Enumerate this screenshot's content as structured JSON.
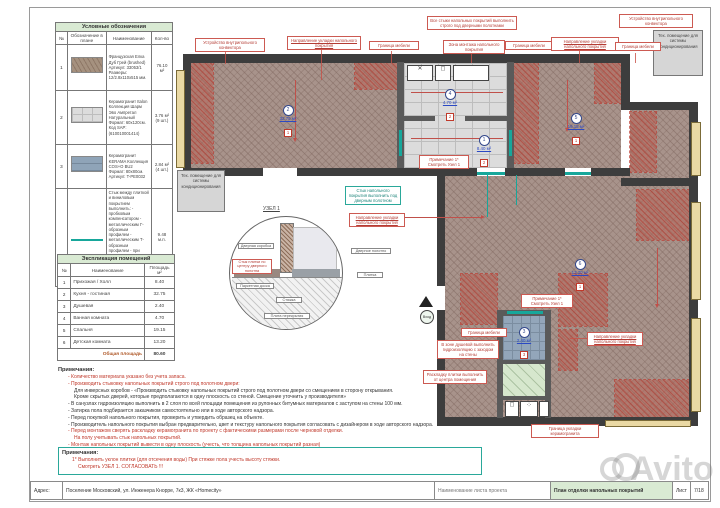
{
  "legend": {
    "title": "Условные обозначения",
    "col_no": "№",
    "col_symbol": "Обозначение в плане",
    "col_name": "Наименование",
    "col_qty": "Кол-во",
    "rows": [
      {
        "no": "1",
        "name": "Французская Елка Дуб Грей (brushed) Артикул: 33053/1 Размеры: 12/2.8х110х515 мм.",
        "qty": "76.10 м²"
      },
      {
        "no": "2",
        "name": "Керамогранит Italon Коллекция Шарм Эво Ампретал Натуральный Формат: 60х120см. Код SAP: (610010001414)",
        "qty": "3.76 м² (9 шт.)"
      },
      {
        "no": "3",
        "name": "Керамогранит KERAMA Коллекция COS+O BU2 Формат: 80х80см. Артикул: T-PE0032",
        "qty": "2.84 м² (4 шт.)"
      },
      {
        "no": "",
        "name": "Стык между плиткой и виниловым покрытием выполнить: - пробковым компенсатором - металлическим Г-образным профилем - металлическим Т-образным профилем - при помощи Силиконового герметика",
        "name_red": "Точный цвет и тип стыка уточнить в ходе авторского надзора",
        "qty": "9.48 м.п."
      }
    ]
  },
  "explication": {
    "title": "Экспликация помещений",
    "col_no": "№",
    "col_name": "Наименование",
    "col_area": "Площадь м²",
    "rows": [
      {
        "no": "1",
        "name": "Прихожая / Холл",
        "area": "8.40"
      },
      {
        "no": "2",
        "name": "Кухня - гостиная",
        "area": "32.75"
      },
      {
        "no": "3",
        "name": "Душевая",
        "area": "2.40"
      },
      {
        "no": "4",
        "name": "Ванная комната",
        "area": "4.70"
      },
      {
        "no": "5",
        "name": "Спальня",
        "area": "19.15"
      },
      {
        "no": "6",
        "name": "Детская комната",
        "area": "13.20"
      }
    ],
    "total_label": "Общая площадь",
    "total_value": "80.60"
  },
  "notes": {
    "title": "Примечания:",
    "items": [
      {
        "text": "-   Количество материала указано без учета запаса."
      },
      {
        "text": "-   Производить стыковку напольных покрытий строго под полотном двери:"
      },
      {
        "text": "Для инверсных коробов - «Производить стыковку напольных покрытий строго под полотном двери со смещением в сторону открывания."
      },
      {
        "text": "Кроме скрытых дверей, которые предполагаются в одну плоскость со стеной. Смещение уточнить у производителя»"
      },
      {
        "text": "-   В санузлах гидроизоляцию выполнить в 2 слоя по всей площади помещения из рулонных битумных материалов с заступом на стены 100 мм."
      },
      {
        "text": "-   Затирка пола подбирается заказчиком самостоятельно или в ходе авторского надзора."
      },
      {
        "text": "-   Перед покупкой напольного покрытия, проверить и утвердить образец на объекте."
      },
      {
        "text": "-   Производитель напольного покрытия выбран предварительно, цвет и текстуру напольного покрытия согласовать с дизайнером в ходе авторского надзора."
      },
      {
        "text": "-   Перед монтажом сверять раскладку керамогранита по проекту с фактическими размерами после черновой отделки."
      },
      {
        "text": "На полу учитывать стык напольных покрытий."
      },
      {
        "text": "-   Монтаж напольных покрытий вывести в одну плоскость (учесть, что толщина напольных покрытий разная)"
      }
    ]
  },
  "notes2": {
    "title": "Примечания:",
    "line1": "1*  Выполнить уклон плитки (для отсечения воды) При стяжке пола учесть высоту стяжки.",
    "line2": "Смотреть УЗЕЛ 1. СОГЛАСОВАТЬ !!!"
  },
  "titlebar": {
    "address_label": "Адрес:",
    "address": "Поселение Московский, ул. Инженера Кнорре, 7к3, ЖК «Homecity»",
    "sheet_name_label": "Наименование листа проекта",
    "sheet_name": "План отделки напольных покрытий",
    "list_label": "Лист",
    "list_value": "7/18"
  },
  "plan": {
    "callouts": {
      "c1": "Устройство внутрипольного конвектора",
      "c2": "Направление укладки напольного покрытия",
      "c3": "Граница мебели",
      "c4": "Все стыки напольных покрытий выполнить строго под дверными полотнами",
      "c5": "Зона монтажа напольного покрытия",
      "c6": "Граница мебели",
      "c7": "Направление укладки напольного покрытия",
      "c8": "Граница мебели",
      "c9": "Устройство внутрипольного конвектора",
      "tech_right": "Тех. помещение для системы кондиционирования",
      "tech_left": "Тех. помещение для системы кондиционирования",
      "c12": "Стык напольного покрытия выполнить под дверным полотном",
      "c13": "Направление укладки напольного покрытия",
      "c14": "Примечание 1* Смотреть Узел 1",
      "c15": "Примечание 1* Смотреть Узел 1",
      "c16": "Граница мебели",
      "c17": "В зоне душевой выполнить гидроизоляцию с заходом на стены",
      "c18": "Раскладку плитки выполнить от центра помещения",
      "c19": "Направление укладки напольного покрытия",
      "c20": "Граница укладки керамогранита"
    },
    "badges": [
      {
        "num": "2",
        "area": "32.75 м²",
        "fin": "1"
      },
      {
        "num": "4",
        "area": "4.70 м²",
        "fin": "2"
      },
      {
        "num": "1",
        "area": "8.40 м²",
        "fin": "2"
      },
      {
        "num": "5",
        "area": "19.15 м²",
        "fin": "1"
      },
      {
        "num": "6",
        "area": "13.20 м²",
        "fin": "1"
      },
      {
        "num": "3",
        "area": "2.40 м²",
        "fin": "3"
      }
    ],
    "entry_label": "Вход",
    "detail": {
      "title": "УЗЕЛ 1",
      "door_frame": "Дверная коробка",
      "joint": "Стык плитки по центру дверного полотна",
      "parquet": "Паркетная доска",
      "screed": "Стяжка",
      "slab": "Плита перекрытия",
      "door_leaf": "Дверное полотно",
      "tile": "Плитка"
    }
  },
  "watermark": "Avito",
  "colors": {
    "wood": "#a8938b",
    "tile_gray": "#dcdcdc",
    "tile_blue": "#93a6ba",
    "shower_green": "#d6e7cd",
    "wall": "#3d3d3d",
    "annotation_red": "#c0392b",
    "seam_teal": "#17a79b",
    "header_green": "#d9ead3"
  }
}
